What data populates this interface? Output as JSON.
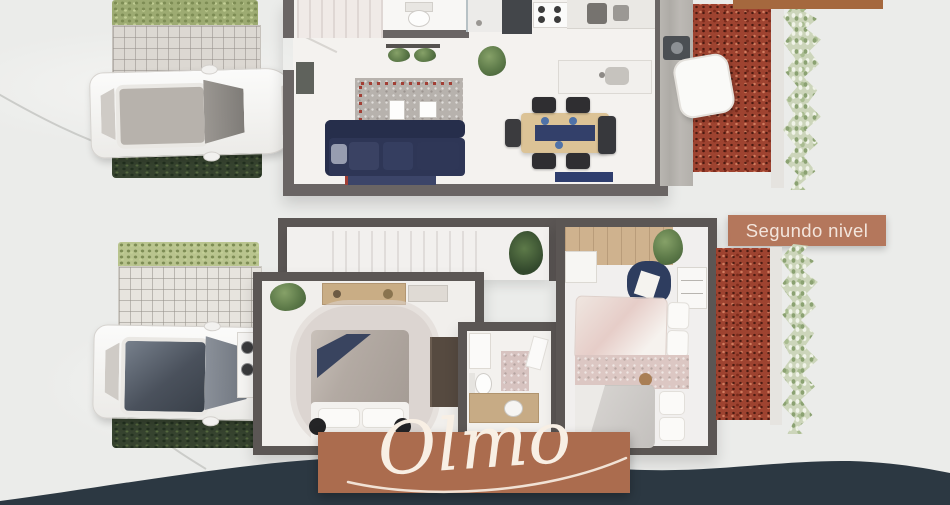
{
  "meta": {
    "description": "Real-estate rendering with top-down 3D floor plans of the Olmo house model, first and second level, with parked cars, gardens and terracotta labels"
  },
  "labels": {
    "second_level_badge": "Segundo nivel",
    "model_banner": "Olmo"
  },
  "colors": {
    "background": "#ebecea",
    "badge_terracotta": "#b4775c",
    "banner_terracotta": "#ab6c4e",
    "top_right_bar": "#a5683e",
    "bottom_band": "#2c3842",
    "wall_gray_first": "#6a6564",
    "wall_gray_second": "#5b5654",
    "sofa_navy": "#2e3656",
    "gravel_red": "#9e4330",
    "vine_green": "#ccd5ba",
    "wood": "#dcc396"
  },
  "plans": {
    "first_level": {
      "features": [
        "white-suv-car",
        "hedge",
        "paver-driveway",
        "dark-lawn",
        "entry-door",
        "stairs",
        "bathroom-toilet",
        "shower",
        "kitchen-cabinet",
        "stove",
        "kitchen-counter",
        "sink-counter",
        "potted-plant",
        "hanging-plant-shelf",
        "gray-accent-rug",
        "picture-frames",
        "navy-l-sofa",
        "runner-rug",
        "dining-table",
        "dining-chairs",
        "high-chair",
        "bench",
        "laundry-machine",
        "hanging-chair",
        "red-gravel-garden",
        "climbing-vine"
      ]
    },
    "second_level": {
      "features": [
        "white-car-dark-roof",
        "hedge",
        "paver-driveway",
        "dark-lawn",
        "stair-hall",
        "potted-plants",
        "master-bed",
        "fluffy-rug",
        "desk-shelf",
        "wardrobe",
        "washer-dryer",
        "bathroom-cabinet",
        "toilet",
        "bath-rug",
        "wood-vanity",
        "kids-bed-pink",
        "kids-bed-gray",
        "area-rug",
        "reading-chair",
        "bookshelf",
        "teddy-bear",
        "red-gravel-garden",
        "climbing-vine"
      ]
    }
  }
}
